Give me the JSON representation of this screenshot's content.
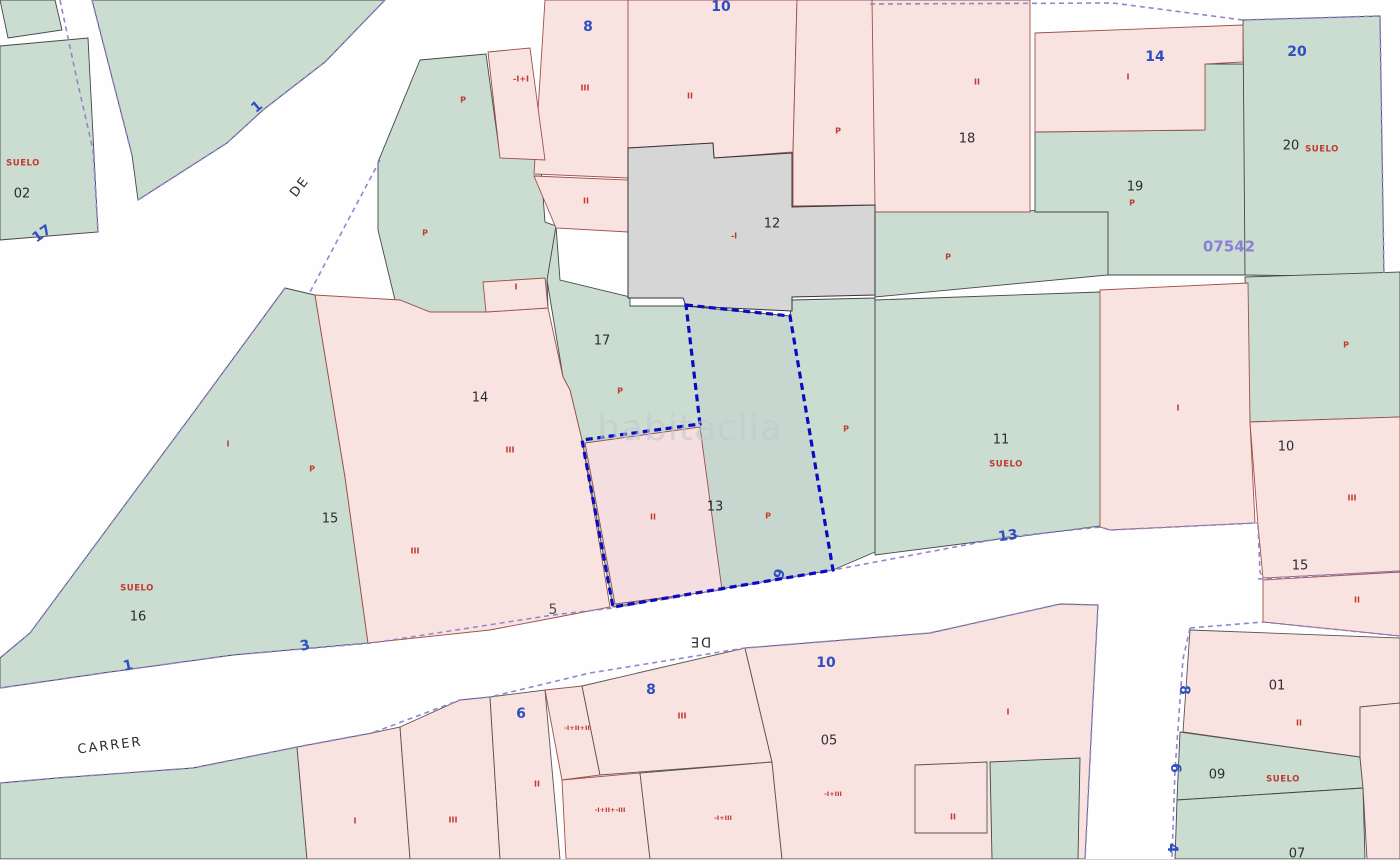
{
  "map": {
    "watermark": "habitaclia",
    "zone_code": "07542",
    "highlighted_parcel": {
      "number": "13",
      "outline_color": "#0b0bc4"
    },
    "colors": {
      "parcel_green": "#cbdcd0",
      "parcel_pink": "#f9e3e1",
      "building_gray": "#d6d6d6",
      "street_boundary_purple": "#9186d0",
      "highlight_blue": "#0b0bc4",
      "label_red": "#bf3a31",
      "street_number_blue": "#2f4ec2"
    },
    "labels": [
      {
        "n": "suelo-label-02",
        "t": "SUELO",
        "x": 23,
        "y": 163,
        "r": 0,
        "c": "suelo"
      },
      {
        "n": "parcel-number-02",
        "t": "02",
        "x": 22,
        "y": 194,
        "r": 0,
        "c": "pnum"
      },
      {
        "n": "street-number-17",
        "t": "17",
        "x": 42,
        "y": 234,
        "r": -35,
        "c": "street"
      },
      {
        "n": "street-number-1-top",
        "t": "1",
        "x": 257,
        "y": 107,
        "r": -40,
        "c": "street"
      },
      {
        "n": "street-name-de-upper",
        "t": "DE",
        "x": 300,
        "y": 187,
        "r": -52,
        "c": "sname"
      },
      {
        "n": "street-number-8-top",
        "t": "8",
        "x": 588,
        "y": 27,
        "r": 0,
        "c": "street"
      },
      {
        "n": "height-code-top1",
        "t": "-I+I",
        "x": 521,
        "y": 79,
        "r": 0,
        "c": "red"
      },
      {
        "n": "p-label-1",
        "t": "P",
        "x": 463,
        "y": 100,
        "r": 0,
        "c": "red"
      },
      {
        "n": "storeys-iii-1",
        "t": "III",
        "x": 585,
        "y": 88,
        "r": 0,
        "c": "red"
      },
      {
        "n": "storeys-ii-1",
        "t": "II",
        "x": 690,
        "y": 96,
        "r": 0,
        "c": "red"
      },
      {
        "n": "street-number-10-top",
        "t": "10",
        "x": 721,
        "y": 7,
        "r": 0,
        "c": "street"
      },
      {
        "n": "p-label-2",
        "t": "P",
        "x": 838,
        "y": 131,
        "r": 0,
        "c": "red"
      },
      {
        "n": "storeys-ii-2",
        "t": "II",
        "x": 977,
        "y": 82,
        "r": 0,
        "c": "red"
      },
      {
        "n": "parcel-number-18",
        "t": "18",
        "x": 967,
        "y": 139,
        "r": 0,
        "c": "pnum"
      },
      {
        "n": "street-number-14",
        "t": "14",
        "x": 1155,
        "y": 57,
        "r": 0,
        "c": "street"
      },
      {
        "n": "storeys-i-1",
        "t": "I",
        "x": 1128,
        "y": 77,
        "r": 0,
        "c": "red"
      },
      {
        "n": "street-number-20",
        "t": "20",
        "x": 1297,
        "y": 52,
        "r": 0,
        "c": "street"
      },
      {
        "n": "parcel-number-20",
        "t": "20",
        "x": 1291,
        "y": 146,
        "r": 0,
        "c": "pnum"
      },
      {
        "n": "suelo-label-20",
        "t": "SUELO",
        "x": 1322,
        "y": 149,
        "r": 0,
        "c": "suelo"
      },
      {
        "n": "parcel-number-19",
        "t": "19",
        "x": 1135,
        "y": 187,
        "r": 0,
        "c": "pnum"
      },
      {
        "n": "p-label-3",
        "t": "P",
        "x": 1132,
        "y": 203,
        "r": 0,
        "c": "red"
      },
      {
        "n": "zone-code",
        "t": "07542",
        "x": 1229,
        "y": 247,
        "r": 0,
        "c": "zone"
      },
      {
        "n": "p-label-4",
        "t": "P",
        "x": 948,
        "y": 257,
        "r": 0,
        "c": "red"
      },
      {
        "n": "parcel-number-12",
        "t": "12",
        "x": 772,
        "y": 224,
        "r": 0,
        "c": "pnum"
      },
      {
        "n": "height-code-12",
        "t": "-I",
        "x": 734,
        "y": 236,
        "r": 0,
        "c": "red"
      },
      {
        "n": "storeys-ii-3",
        "t": "II",
        "x": 586,
        "y": 201,
        "r": 0,
        "c": "red"
      },
      {
        "n": "storeys-i-2",
        "t": "I",
        "x": 516,
        "y": 287,
        "r": 0,
        "c": "red"
      },
      {
        "n": "parcel-number-17",
        "t": "17",
        "x": 602,
        "y": 341,
        "r": 0,
        "c": "pnum"
      },
      {
        "n": "p-label-5",
        "t": "P",
        "x": 620,
        "y": 391,
        "r": 0,
        "c": "red"
      },
      {
        "n": "p-label-6",
        "t": "P",
        "x": 425,
        "y": 233,
        "r": 0,
        "c": "red"
      },
      {
        "n": "parcel-number-14",
        "t": "14",
        "x": 480,
        "y": 398,
        "r": 0,
        "c": "pnum"
      },
      {
        "n": "storeys-iii-2",
        "t": "III",
        "x": 510,
        "y": 450,
        "r": 0,
        "c": "red"
      },
      {
        "n": "storeys-i-3",
        "t": "I",
        "x": 228,
        "y": 444,
        "r": 0,
        "c": "red"
      },
      {
        "n": "p-label-7",
        "t": "P",
        "x": 312,
        "y": 469,
        "r": 0,
        "c": "red"
      },
      {
        "n": "parcel-number-15",
        "t": "15",
        "x": 330,
        "y": 519,
        "r": 0,
        "c": "pnum"
      },
      {
        "n": "storeys-iii-3",
        "t": "III",
        "x": 415,
        "y": 551,
        "r": 0,
        "c": "red"
      },
      {
        "n": "suelo-label-16",
        "t": "SUELO",
        "x": 137,
        "y": 588,
        "r": 0,
        "c": "suelo"
      },
      {
        "n": "parcel-number-16",
        "t": "16",
        "x": 138,
        "y": 617,
        "r": 0,
        "c": "pnum"
      },
      {
        "n": "storeys-ii-highlight",
        "t": "II",
        "x": 653,
        "y": 517,
        "r": 0,
        "c": "red"
      },
      {
        "n": "parcel-number-13",
        "t": "13",
        "x": 715,
        "y": 507,
        "r": 0,
        "c": "pnum"
      },
      {
        "n": "p-label-8",
        "t": "P",
        "x": 768,
        "y": 516,
        "r": 0,
        "c": "red"
      },
      {
        "n": "p-label-9",
        "t": "P",
        "x": 846,
        "y": 429,
        "r": 0,
        "c": "red"
      },
      {
        "n": "parcel-number-11",
        "t": "11",
        "x": 1001,
        "y": 440,
        "r": 0,
        "c": "pnum"
      },
      {
        "n": "suelo-label-11",
        "t": "SUELO",
        "x": 1006,
        "y": 464,
        "r": 0,
        "c": "suelo"
      },
      {
        "n": "storeys-i-4",
        "t": "I",
        "x": 1178,
        "y": 408,
        "r": 0,
        "c": "red"
      },
      {
        "n": "p-label-10",
        "t": "P",
        "x": 1346,
        "y": 345,
        "r": 0,
        "c": "red"
      },
      {
        "n": "parcel-number-10r",
        "t": "10",
        "x": 1286,
        "y": 447,
        "r": 0,
        "c": "pnum"
      },
      {
        "n": "storeys-iii-4",
        "t": "III",
        "x": 1352,
        "y": 498,
        "r": 0,
        "c": "red"
      },
      {
        "n": "street-number-15r",
        "t": "15",
        "x": 1300,
        "y": 566,
        "r": 0,
        "c": "pnum"
      },
      {
        "n": "storeys-ii-4",
        "t": "II",
        "x": 1357,
        "y": 600,
        "r": 0,
        "c": "red"
      },
      {
        "n": "street-number-13",
        "t": "13",
        "x": 1008,
        "y": 536,
        "r": -8,
        "c": "street"
      },
      {
        "n": "street-number-9",
        "t": "9",
        "x": 780,
        "y": 574,
        "r": -70,
        "c": "street"
      },
      {
        "n": "street-number-5",
        "t": "5",
        "x": 553,
        "y": 610,
        "r": 0,
        "c": "snum-dark"
      },
      {
        "n": "street-number-3",
        "t": "3",
        "x": 305,
        "y": 646,
        "r": -12,
        "c": "street"
      },
      {
        "n": "street-number-1-bottom",
        "t": "1",
        "x": 128,
        "y": 666,
        "r": -12,
        "c": "street"
      },
      {
        "n": "street-name-carrer",
        "t": "CARRER",
        "x": 110,
        "y": 746,
        "r": -7,
        "c": "sname"
      },
      {
        "n": "street-name-de-lower",
        "t": "DE",
        "x": 700,
        "y": 641,
        "r": 180,
        "c": "sname"
      },
      {
        "n": "watermark-text",
        "t": "habitaclia",
        "x": 690,
        "y": 430,
        "r": 0,
        "c": "watermark"
      },
      {
        "n": "street-number-6",
        "t": "6",
        "x": 521,
        "y": 714,
        "r": 0,
        "c": "street"
      },
      {
        "n": "storeys-ii-5",
        "t": "II",
        "x": 537,
        "y": 784,
        "r": 0,
        "c": "red"
      },
      {
        "n": "street-number-8-mid",
        "t": "8",
        "x": 651,
        "y": 690,
        "r": 0,
        "c": "street"
      },
      {
        "n": "storeys-iii-5",
        "t": "III",
        "x": 682,
        "y": 716,
        "r": 0,
        "c": "red"
      },
      {
        "n": "height-code-b1",
        "t": "-I+II+II",
        "x": 577,
        "y": 728,
        "r": 0,
        "c": "code"
      },
      {
        "n": "height-code-b2",
        "t": "-I+II+-III",
        "x": 610,
        "y": 810,
        "r": 0,
        "c": "code"
      },
      {
        "n": "height-code-b3",
        "t": "-I+III",
        "x": 723,
        "y": 818,
        "r": 0,
        "c": "code"
      },
      {
        "n": "street-number-10-mid",
        "t": "10",
        "x": 826,
        "y": 663,
        "r": 0,
        "c": "street"
      },
      {
        "n": "parcel-number-05",
        "t": "05",
        "x": 829,
        "y": 741,
        "r": 0,
        "c": "pnum"
      },
      {
        "n": "height-code-b4",
        "t": "-I+III",
        "x": 833,
        "y": 794,
        "r": 0,
        "c": "code"
      },
      {
        "n": "storeys-ii-6",
        "t": "II",
        "x": 953,
        "y": 817,
        "r": 0,
        "c": "red"
      },
      {
        "n": "storeys-i-5",
        "t": "I",
        "x": 1008,
        "y": 712,
        "r": 0,
        "c": "red"
      },
      {
        "n": "street-number-8-right",
        "t": "8",
        "x": 1184,
        "y": 690,
        "r": 90,
        "c": "street"
      },
      {
        "n": "street-number-6-right",
        "t": "6",
        "x": 1175,
        "y": 768,
        "r": 90,
        "c": "street"
      },
      {
        "n": "street-number-4-right",
        "t": "4",
        "x": 1172,
        "y": 848,
        "r": 90,
        "c": "street"
      },
      {
        "n": "parcel-number-01",
        "t": "01",
        "x": 1277,
        "y": 686,
        "r": 0,
        "c": "pnum"
      },
      {
        "n": "storeys-ii-7",
        "t": "II",
        "x": 1299,
        "y": 723,
        "r": 0,
        "c": "red"
      },
      {
        "n": "parcel-number-09",
        "t": "09",
        "x": 1217,
        "y": 775,
        "r": 0,
        "c": "pnum"
      },
      {
        "n": "suelo-label-09",
        "t": "SUELO",
        "x": 1283,
        "y": 779,
        "r": 0,
        "c": "suelo"
      },
      {
        "n": "parcel-number-07",
        "t": "07",
        "x": 1297,
        "y": 854,
        "r": 0,
        "c": "pnum"
      },
      {
        "n": "storeys-i-6",
        "t": "I",
        "x": 355,
        "y": 821,
        "r": 0,
        "c": "red"
      },
      {
        "n": "storeys-iii-6",
        "t": "III",
        "x": 453,
        "y": 820,
        "r": 0,
        "c": "red"
      }
    ]
  }
}
